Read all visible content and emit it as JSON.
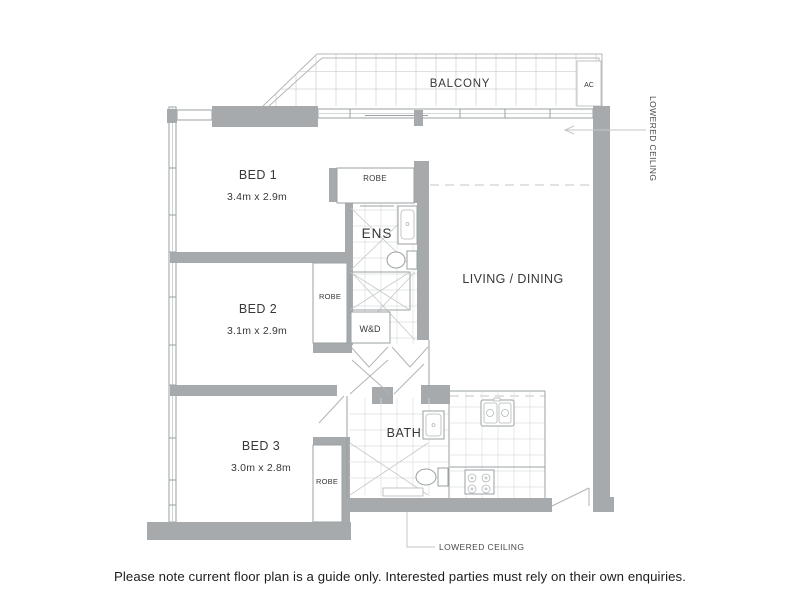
{
  "balcony": {
    "label": "BALCONY",
    "ac": "AC"
  },
  "rooms": {
    "bed1": {
      "name": "BED 1",
      "dims": "3.4m x 2.9m"
    },
    "bed2": {
      "name": "BED 2",
      "dims": "3.1m x 2.9m"
    },
    "bed3": {
      "name": "BED 3",
      "dims": "3.0m x 2.8m"
    },
    "living": {
      "name": "LIVING / DINING"
    },
    "ens": {
      "name": "ENS"
    },
    "bath": {
      "name": "BATH"
    },
    "wd": {
      "name": "W&D"
    },
    "robe_bed1": {
      "name": "ROBE"
    },
    "robe_bed2": {
      "name": "ROBE"
    },
    "robe_bed3": {
      "name": "ROBE"
    }
  },
  "annotations": {
    "lowered_ceiling_right": "LOWERED CEILING",
    "lowered_ceiling_bottom": "LOWERED CEILING"
  },
  "footer": {
    "disclaimer": "Please note current floor plan is a guide only. Interested parties must rely on their own enquiries."
  },
  "colors": {
    "wall_gray": "#a6aaad",
    "line_gray": "#9aa0a3",
    "tile_gray": "#dddfe0",
    "text_dark": "#383838"
  }
}
